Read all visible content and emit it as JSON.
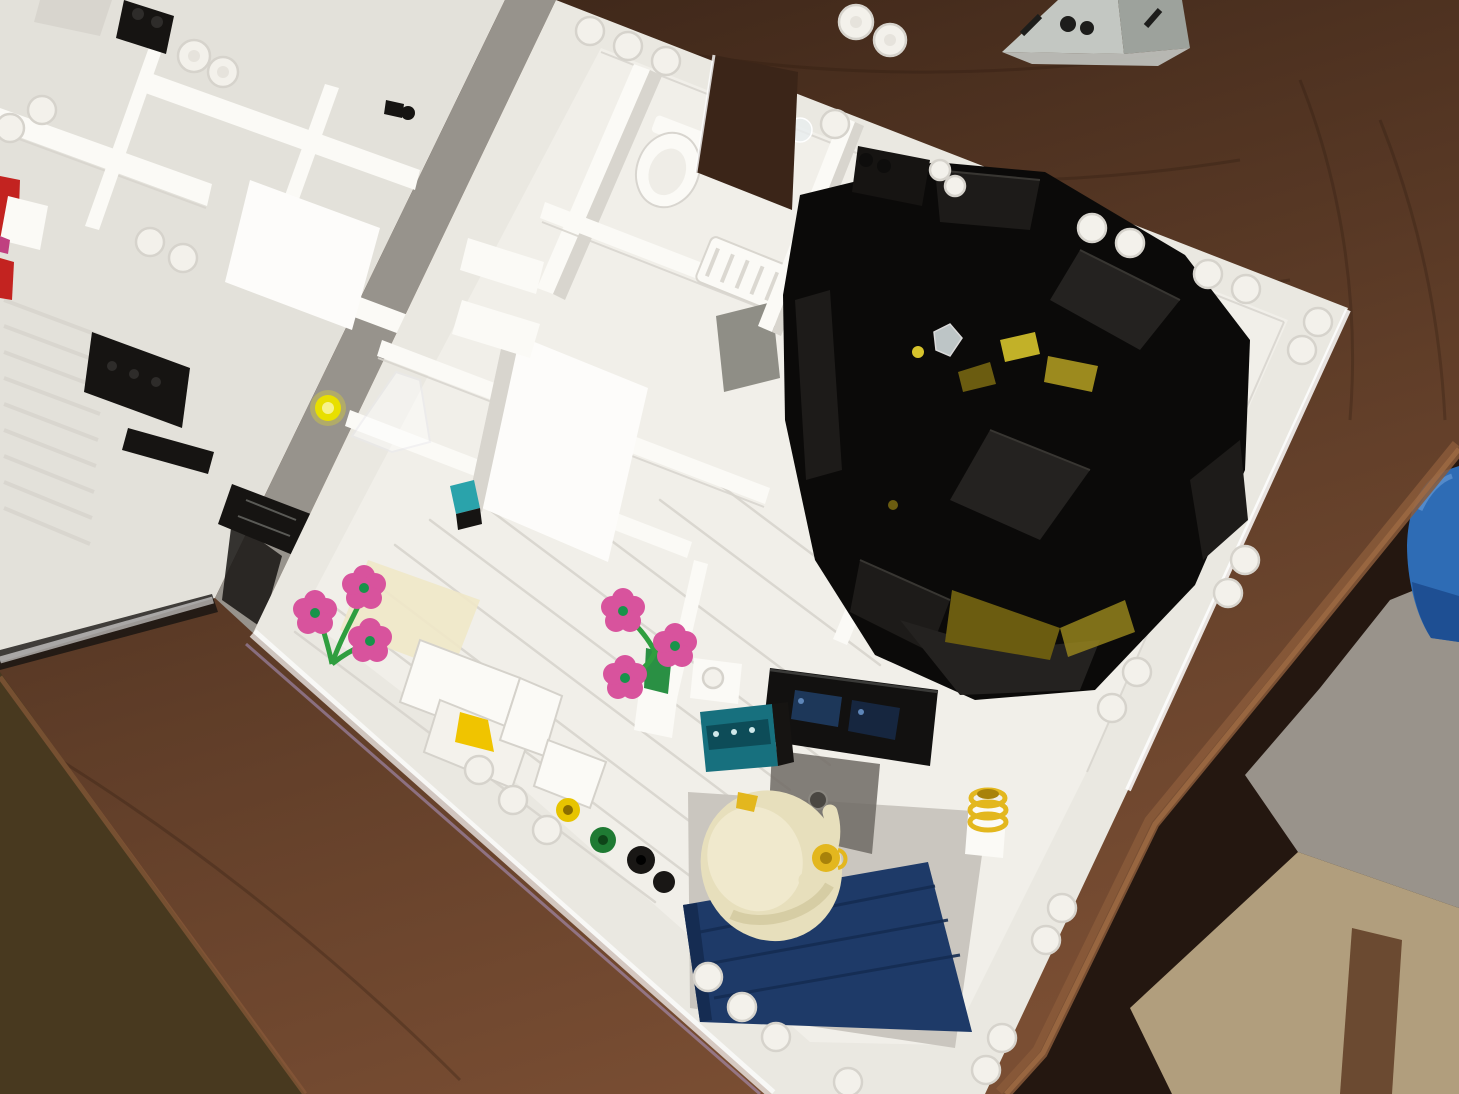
{
  "image": {
    "kind": "photograph",
    "width": 1459,
    "height": 1094,
    "subject": "Overhead view of a white LEGO modular building interior under construction, sitting on a dark wooden table"
  },
  "scene": {
    "caption": "A roofless white LEGO building interior photographed from above on a wooden table: white rooms with stud-lined perimeter walls, a sunken black home-cinema pit with amber glass glints, two clusters of pink LEGO flowers, a bathroom with white fixtures, and an office room with a dark blue tiled floor, black desk, teal control panel, cream egg chair and a yellow mug.",
    "objects": [
      {
        "name": "wooden-table",
        "color": "wood_mid",
        "note": "dark reddish-brown tabletop filling the background"
      },
      {
        "name": "table-edge",
        "color": "wood_edge",
        "note": "lighter rough table edge running diagonally lower right"
      },
      {
        "name": "floor-carpet",
        "color": "carpet",
        "note": "beige carpet visible beyond the table, bottom right"
      },
      {
        "name": "gray-room-wall",
        "color": "gray_wall",
        "note": "blurred gray wall/floor beyond the table edge"
      },
      {
        "name": "blue-bucket",
        "color": "bucket_blue",
        "note": "royal blue rounded object at right edge"
      },
      {
        "name": "gray-lego-structure",
        "color": "pyr_gray",
        "note": "small light-gray sloped LEGO stack at top edge"
      },
      {
        "name": "left-room-module",
        "color": "plate_white2",
        "note": "partially visible second white module, top left"
      },
      {
        "name": "main-room-module",
        "color": "plate_white",
        "note": "large white module with stud-lined perimeter walls"
      },
      {
        "name": "wall-opening",
        "color": "wood_dark",
        "note": "door-shaped gap in top wall showing the table through it"
      },
      {
        "name": "bathroom-fixtures",
        "color": "wall_white",
        "count": 3,
        "note": "white toilet, barrels and ribbed radiator piece"
      },
      {
        "name": "home-cinema-pit",
        "color": "pit_black",
        "note": "sunken black-brick room with tiered black benches"
      },
      {
        "name": "amber-glass-panels",
        "color": "amber_bright",
        "count": 4,
        "note": "trans-yellow glints inside the black pit"
      },
      {
        "name": "crystal-piece",
        "color": "crystal",
        "note": "small clear faceted gem on the pit rim"
      },
      {
        "name": "pink-flower-clusters",
        "color": "pink",
        "count": 2,
        "flowers_total": 6,
        "note": "pink 5-petal flowers on green stems, one in a green vase"
      },
      {
        "name": "white-armchair",
        "color": "wall_white",
        "note": "white sloped furniture in the living area"
      },
      {
        "name": "yellow-cone",
        "color": "cone_yellow",
        "note": "bright yellow wedge next to the armchair"
      },
      {
        "name": "round-bins",
        "colors": [
          "bin_yellow",
          "bin_green",
          "bin_black"
        ],
        "count": 3,
        "note": "yellow, green and black 1x1 round pieces by the lower wall"
      },
      {
        "name": "trans-yellow-tile",
        "color": "trans_yellow_tile",
        "note": "glowing trans-yellow round tile on the floor, center left"
      },
      {
        "name": "trans-clear-cone",
        "color": "trans_clear",
        "note": "translucent clear piece beside the yellow tile"
      },
      {
        "name": "teal-tile",
        "color": "teal_tile",
        "note": "small dark-turquoise tile on a hallway wall"
      },
      {
        "name": "office-desk",
        "color": "desk_black",
        "note": "black desk with dark blue screen glints"
      },
      {
        "name": "teal-control-panel",
        "color": "teal_panel",
        "note": "printed teal control tiles beside the desk"
      },
      {
        "name": "cream-egg-chair",
        "color": "tan",
        "note": "large cream rounded chair/figure with tan arm"
      },
      {
        "name": "yellow-mug",
        "color": "mug",
        "note": "yellow cup held at the chair arm"
      },
      {
        "name": "white-cup-yellow-rings",
        "colors": [
          "wall_white",
          "mug"
        ],
        "note": "white cylinder with yellow coils, right of chair"
      },
      {
        "name": "blue-tile-floor",
        "color": "blue_floor",
        "note": "dark blue tiled floor of the office room"
      },
      {
        "name": "black-grilles",
        "color": "black_piece",
        "count": 4,
        "note": "black louvre/grille strips in the left module"
      },
      {
        "name": "red-brick",
        "color": "red_brick",
        "note": "red brick peeking in at the left edge"
      },
      {
        "name": "black-technic-pin",
        "color": "black_piece",
        "note": "black pin sticking from a white wall, upper left"
      },
      {
        "name": "wall-studs",
        "color": "stud_white",
        "count": 30,
        "note": "round studs along the tops of the perimeter walls"
      }
    ]
  },
  "palette": {
    "wood_dark": "#3b2518",
    "wood_mid": "#5f3d28",
    "wood_light": "#7a4e33",
    "wood_grain": "#2c1a0f",
    "wood_edge": "#8a5a39",
    "wood_edge_light": "#a06c44",
    "shadow_olive": "#48391f",
    "beyond_dark": "#241710",
    "carpet": "#b19e7d",
    "carpet_strip": "#6b4a31",
    "gray_wall": "#99938b",
    "gray_floor": "#8b8278",
    "bucket_blue": "#2e6cb5",
    "bucket_blue_dark": "#1e4f93",
    "bucket_sheen": "#6d9fd8",
    "pyr_gray": "#c3c7c2",
    "pyr_gray_dark": "#9da29c",
    "pyr_hole": "#1d1d1b",
    "plate_white": "#eae8e1",
    "plate_white2": "#e3e1da",
    "gap_gray": "#97938c",
    "wall_white": "#fbfaf6",
    "wall_bright": "#fdfcfa",
    "wall_shadow": "#d8d5ce",
    "wall_shadow2": "#c6c3bc",
    "interior_floor": "#f1efe9",
    "floor_line": "#d9d6cf",
    "cream_patch": "#efe8c8",
    "glare_white": "#ffffff",
    "fringe_purple": "#b4a0d6",
    "stud_white": "#f3f1eb",
    "stud_shadow": "#d6d3cc",
    "trans_clear": "#e9edef",
    "pit_black": "#0b0a09",
    "pit_brick": "#1d1b19",
    "pit_brick2": "#242220",
    "pit_edge": "#383632",
    "amber": "#6b5c10",
    "amber_bright": "#d6c32c",
    "amber_mid": "#9c8a1e",
    "crystal": "#dde6e8",
    "black_piece": "#161412",
    "dkgray_panel": "#8f8e86",
    "brown_piece": "#4a2c18",
    "red_brick": "#c32320",
    "magenta": "#c04080",
    "pink": "#d8539d",
    "flower_center": "#18934a",
    "stem": "#2f9e3f",
    "vase_green": "#2a9044",
    "bin_yellow": "#e7c400",
    "bin_yellow_dark": "#8a6d00",
    "bin_green": "#1f7a33",
    "bin_green_dark": "#0e4418",
    "bin_black": "#191715",
    "cone_yellow": "#f0c400",
    "trans_yellow_tile": "#e8df00",
    "teal_tile": "#2aa3ab",
    "teal_panel": "#17707e",
    "teal_panel_dark": "#0d4c58",
    "tan": "#e7dfbc",
    "tan_light": "#f0e9cd",
    "tan_shadow": "#cfc49a",
    "mug": "#e3b71e",
    "mug_dark": "#a8820a",
    "blue_floor": "#1e3a68",
    "blue_floor_dark": "#152c52",
    "desk_black": "#121110",
    "screen_navy": "#1f3a5e",
    "screen_navy2": "#16263f",
    "screen_dot": "#5e86b8",
    "smoke_box": "#6e6a64",
    "smoke_box_dark": "#4a4742",
    "room_floor_gray": "#cac6bf"
  }
}
